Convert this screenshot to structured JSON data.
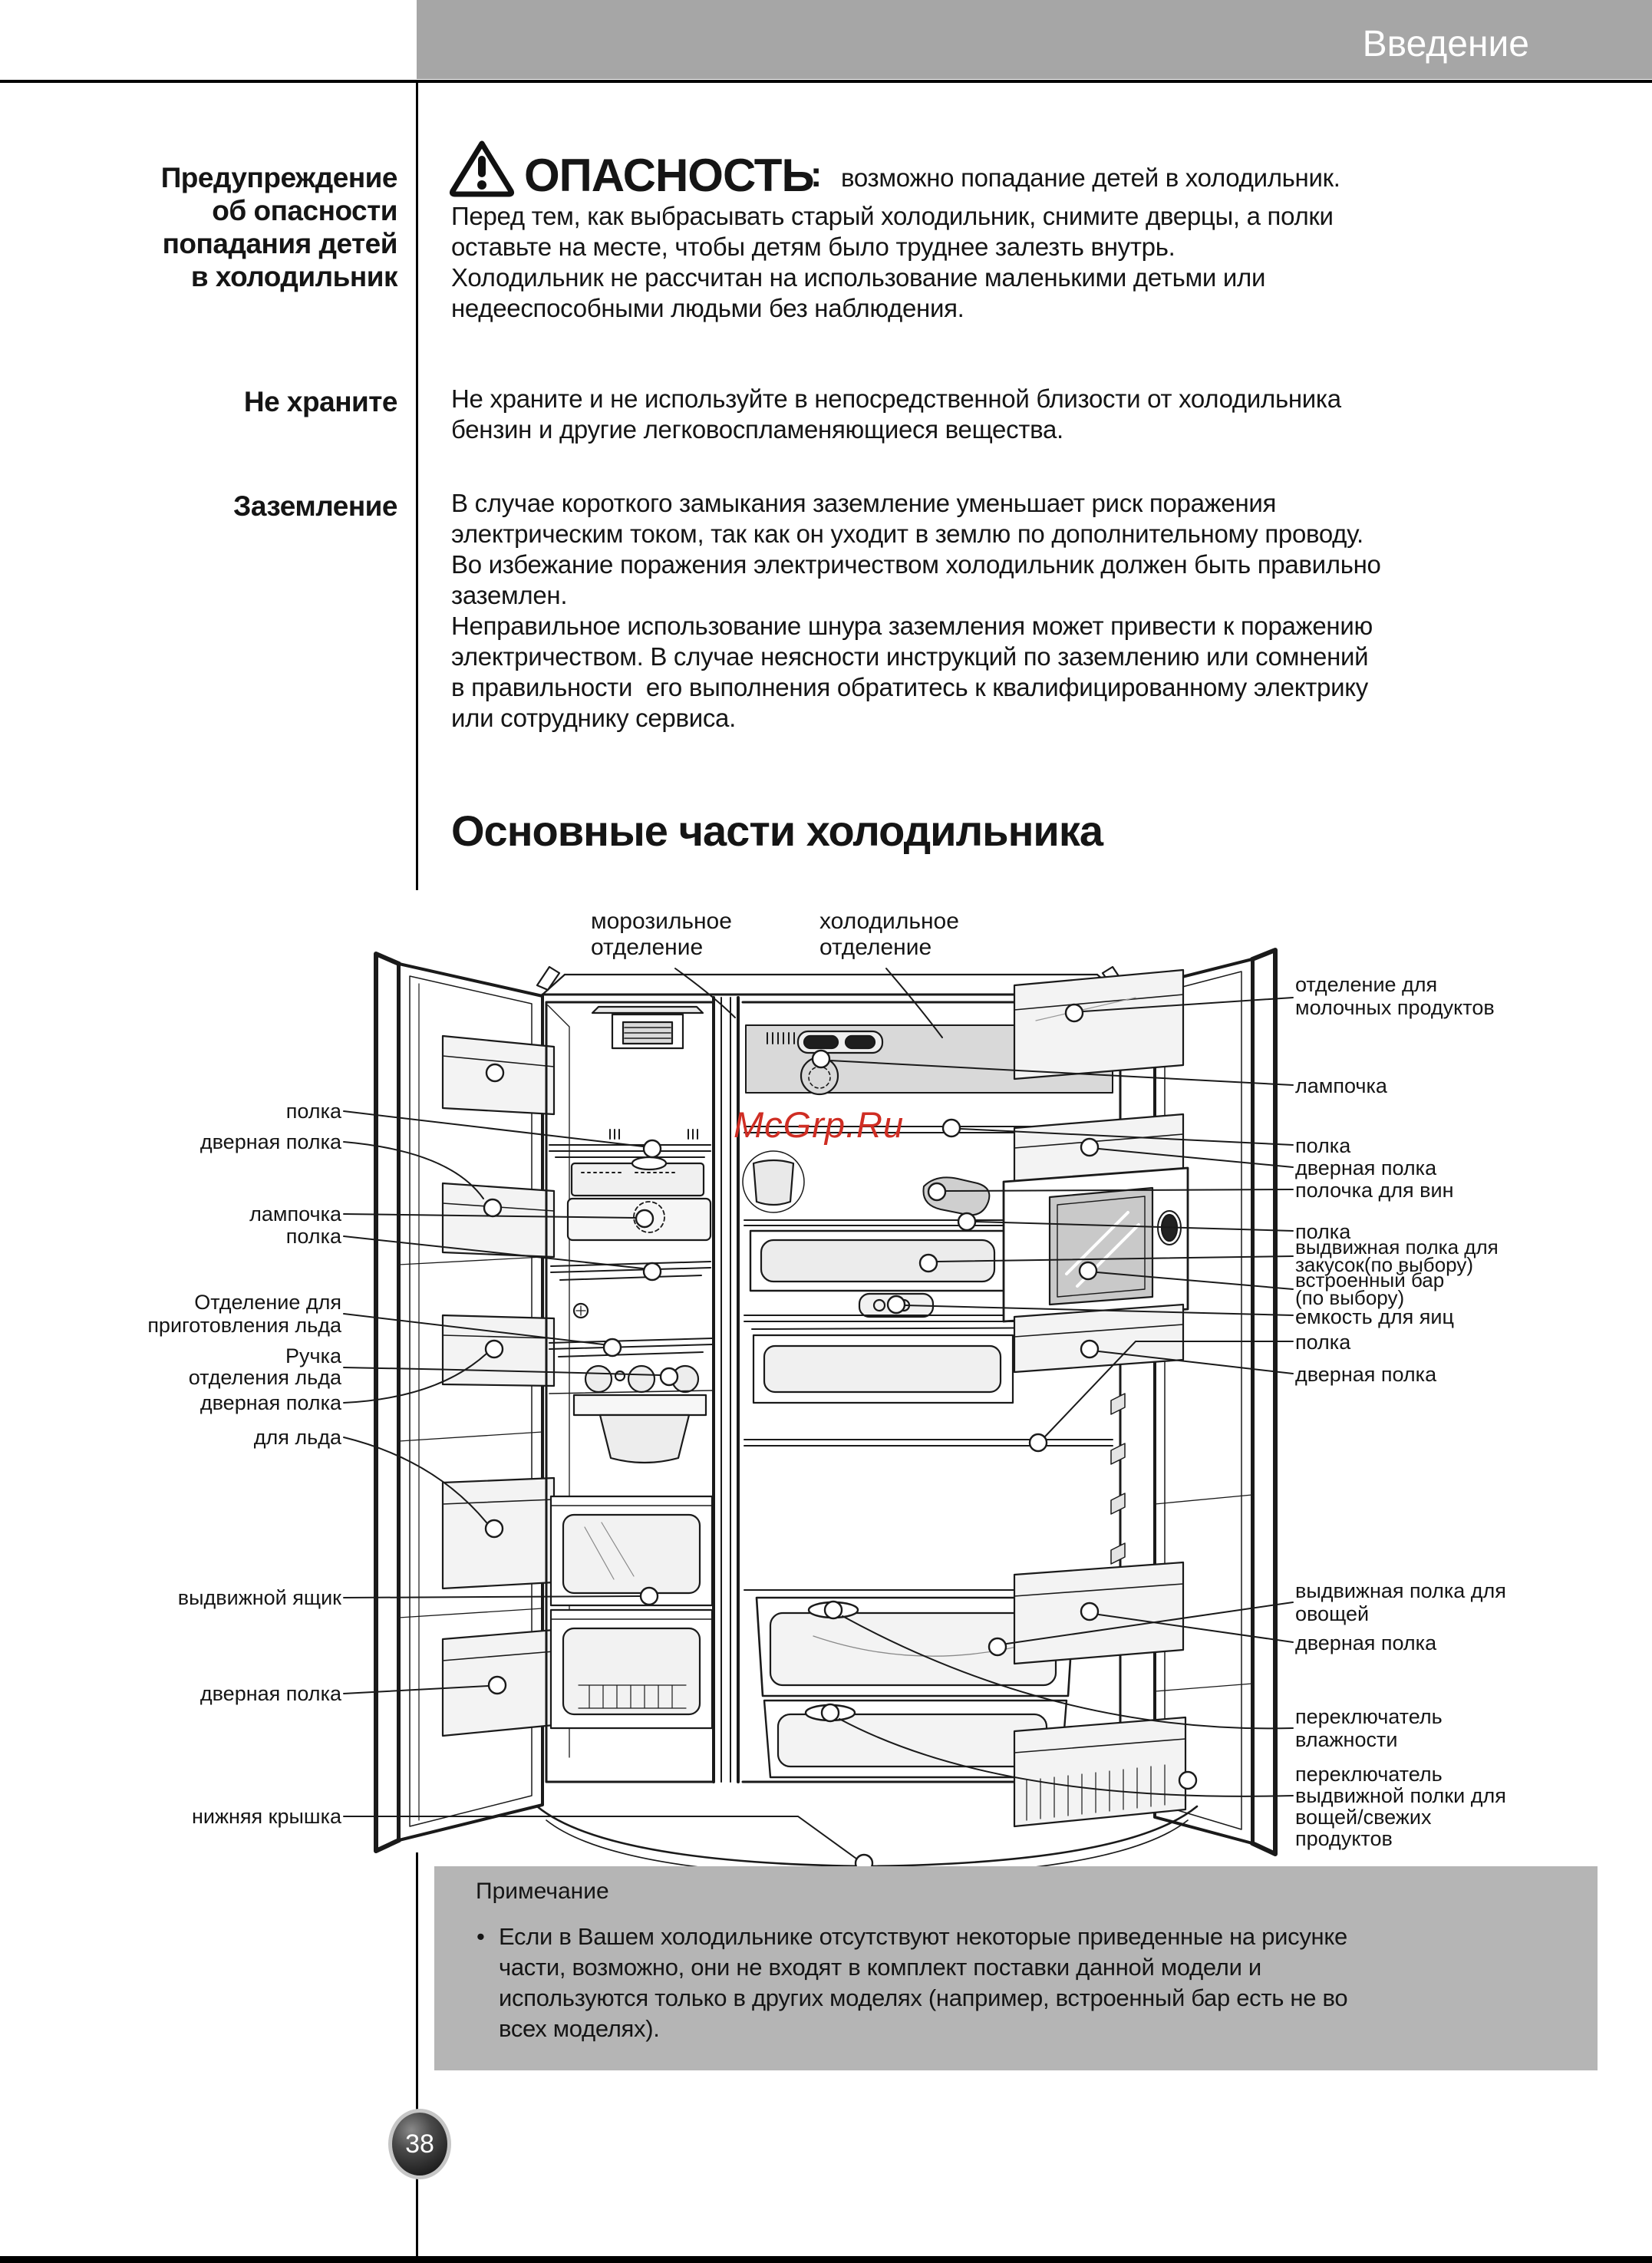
{
  "header": {
    "title": "Введение"
  },
  "sidebar": {
    "warning_heading": "Предупреждение\nоб опасности\nпопадания детей\nв холодильник",
    "store_heading": "Не храните",
    "ground_heading": "Заземление"
  },
  "danger": {
    "title": "ОПАСНОСТЬ",
    "colon": ":",
    "summary": "возможно попадание детей в холодильник.",
    "body": "Перед тем, как выбрасывать старый холодильник, снимите дверцы, а полки\nоставьте на месте, чтобы детям было труднее залезть внутрь.\nХолодильник не рассчитан на использование маленькими детьми или\nнедееспособными людьми без наблюдения."
  },
  "store": {
    "body": "Не храните и не используйте в непосредственной близости от холодильника\nбензин и другие легковоспламеняющиеся вещества."
  },
  "ground": {
    "body": "В случае короткого замыкания заземление уменьшает риск поражения\nэлектрическим током, так как он уходит в землю по дополнительному проводу.\nВо избежание поражения электричеством холодильник должен быть правильно\nзаземлен.\nНеправильное использование шнура заземления может привести к поражению\nэлектричеством. В случае неясности инструкций по заземлению или сомнений\nв правильности  его выполнения обратитесь к квалифицированному электрику\nили сотруднику сервиса."
  },
  "section_title": "Основные части холодильника",
  "diagram": {
    "freezer_label": "морозильное\nотделение",
    "fridge_label": "холодильное\nотделение",
    "watermark": "McGrp.Ru",
    "left_labels": [
      "полка",
      "дверная полка",
      "лампочка",
      "полка",
      "Отделение для\nприготовления льда",
      "Ручка\nотделения льда",
      "дверная полка",
      "для льда",
      "выдвижной ящик",
      "дверная полка",
      "нижняя крышка"
    ],
    "right_labels": [
      "отделение для\nмолочных продуктов",
      "лампочка",
      "полка",
      "дверная полка",
      "полочка для вин",
      "полка",
      "выдвижная полка для\nзакусок(по выбору)",
      "встроенный бар\n(по выбору)",
      "емкость для яиц",
      "полка",
      "дверная полка",
      "выдвижная полка для\nовощей",
      "дверная полка",
      "переключатель\nвлажности",
      "переключатель\nвыдвижной полки для\nвощей/свежих\nпродуктов"
    ]
  },
  "note": {
    "title": "Примечание",
    "bullet": "•",
    "body": "Если в Вашем холодильнике отсутствуют некоторые приведенные на рисунке\nчасти, возможно, они не входят в комплект поставки данной модели и\nиспользуются только в других моделях (например, встроенный бар есть не во\nвсех моделях)."
  },
  "footer": {
    "page_number": "38"
  },
  "colors": {
    "header_bg": "#a6a6a6",
    "note_bg": "#b5b5b5",
    "watermark_red": "#cf2d23",
    "line_black": "#1a1a1a"
  }
}
